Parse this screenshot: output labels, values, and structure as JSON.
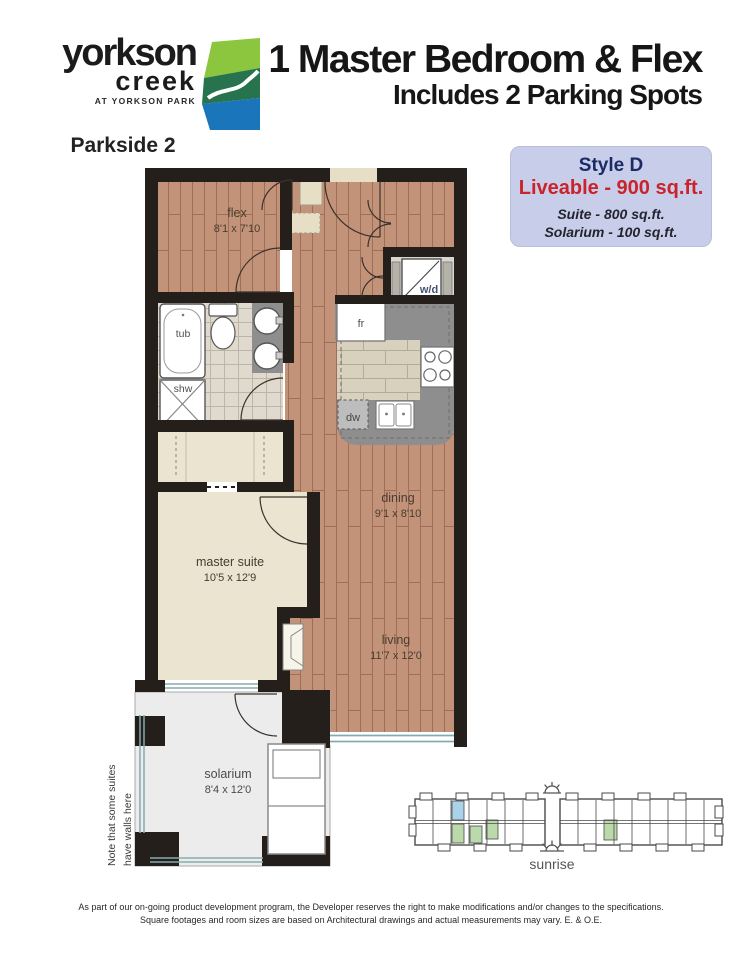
{
  "logo": {
    "brand_top": "yorkson",
    "brand_bottom": "creek",
    "tagline": "AT YORKSON PARK",
    "building": "Parkside 2"
  },
  "header": {
    "title": "1 Master Bedroom & Flex",
    "subtitle": "Includes 2 Parking Spots"
  },
  "style_box": {
    "style_name": "Style D",
    "liveable": "Liveable - 900 sq.ft.",
    "suite": "Suite - 800 sq.ft.",
    "solarium": "Solarium - 100 sq.ft.",
    "bg_color": "#c8cee9",
    "style_color": "#1c2b66",
    "liveable_color": "#c9232b"
  },
  "plan": {
    "rooms": {
      "flex": {
        "name": "flex",
        "dims": "8'1 x 7'10"
      },
      "dining": {
        "name": "dining",
        "dims": "9'1 x 8'10"
      },
      "living": {
        "name": "living",
        "dims": "11'7 x 12'0"
      },
      "master": {
        "name": "master suite",
        "dims": "10'5 x 12'9"
      },
      "solarium": {
        "name": "solarium",
        "dims": "8'4 x 12'0"
      }
    },
    "fixtures": {
      "tub": "tub",
      "shower": "shw",
      "fridge": "fr",
      "dishwasher": "dw",
      "washer_dryer": "w/d"
    },
    "note_line1": "Note that some suites",
    "note_line2": "have walls here",
    "colors": {
      "wall": "#241f1b",
      "wood": "#c39379",
      "carpet": "#eae4d0",
      "counter": "#8e8e8e",
      "window": "#85abb0",
      "solarium_floor": "#ececec"
    }
  },
  "site": {
    "label": "sunrise",
    "highlight_blue": "#aad3e9",
    "highlight_green": "#bcd9ab"
  },
  "disclaimer": {
    "line1": "As part of our on-going product development program, the Developer reserves the right to make modifications and/or changes to the specifications.",
    "line2": "Square footages and room sizes are based on Architectural drawings and actual measurements may vary. E. & O.E."
  }
}
